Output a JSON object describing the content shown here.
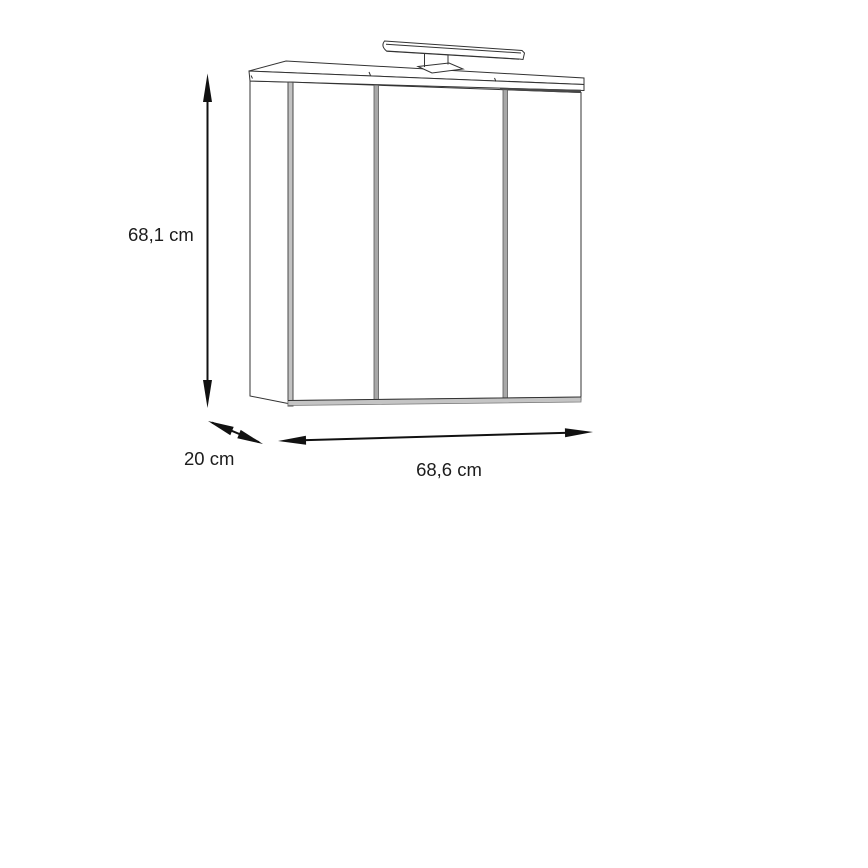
{
  "diagram": {
    "subject": "3-door mirrored bathroom wall cabinet with top light fixture",
    "dimensions": {
      "height": {
        "label": "68,1 cm"
      },
      "depth": {
        "label": "20 cm"
      },
      "width": {
        "label": "68,6 cm"
      }
    },
    "colors": {
      "background": "#ffffff",
      "line": "#333333",
      "arrow": "#111111",
      "label_text": "#1c1c1c",
      "hinge_strip": "#c2c2c2",
      "divider": "#a8a8a8",
      "bottom_strip": "#c4c4c4",
      "shadow_gap": "#474747"
    }
  }
}
